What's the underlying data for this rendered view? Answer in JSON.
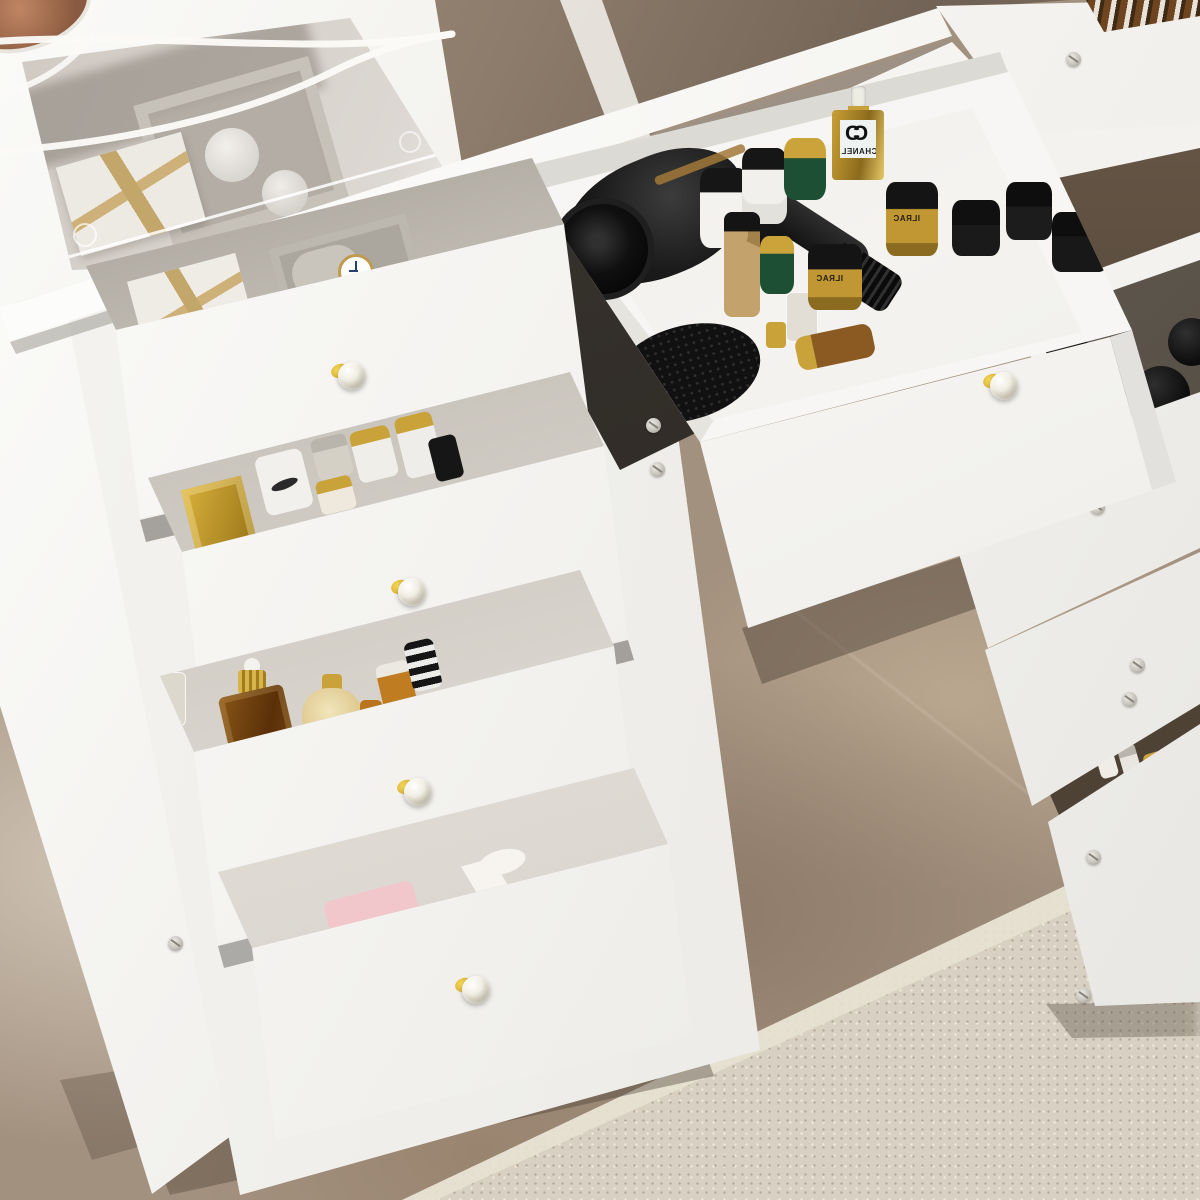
{
  "meta": {
    "description": "Product photo of a white vanity dressing table with a see-through glass top and multiple open crystal-knob drawers filled with cosmetics, perfume bottles, a hair dryer, a brush, a watch and gift boxes, standing on a brown marble floor with a beige rug at lower right."
  },
  "brands": {
    "perfume_logo_left": "C",
    "perfume_logo_right": "C",
    "perfume_name": "CHANEL",
    "jar_label": "ILRAC"
  },
  "palette": {
    "furniture_white": "#f6f5f3",
    "floor_marble": "#a3917f",
    "carpet_beige": "#d8d1c3",
    "glass_tint_brown": "#8d7c6b",
    "gold_accent": "#c9a335",
    "green_jar": "#1d4f35",
    "pink_gift_box": "#efb3b8",
    "appliance_black": "#161616",
    "knob_gold": "#cf9d22"
  },
  "objects": [
    {
      "name": "glass-tabletop",
      "color": "#e3dfda"
    },
    {
      "name": "under-glass-gift-box",
      "color": "#edeae4"
    },
    {
      "name": "under-glass-organizer",
      "color": "#b3ada5"
    },
    {
      "name": "power-cable",
      "color": "#fbfaf7"
    },
    {
      "name": "hair-dryer",
      "color": "#1a1a1a"
    },
    {
      "name": "round-hair-brush",
      "color": "#111111"
    },
    {
      "name": "white-cream-jar-black-lid",
      "color": "#f4f2ee"
    },
    {
      "name": "green-cream-jar-gold-lid",
      "color": "#1d4f35"
    },
    {
      "name": "gold-perfume-bottle-chanel",
      "color": "#caa035"
    },
    {
      "name": "black-cream-jar-gold-label",
      "color": "#c09732"
    },
    {
      "name": "watch-with-gold-rim",
      "color": "#ffffff"
    },
    {
      "name": "white-gift-box-gold-ribbon",
      "color": "#efece6"
    },
    {
      "name": "gold-square-perfume",
      "color": "#c9a335"
    },
    {
      "name": "amber-square-perfume",
      "color": "#6e3f10"
    },
    {
      "name": "cream-round-perfume",
      "color": "#ead9a8"
    },
    {
      "name": "orange-serum-bottles",
      "color": "#c07c20"
    },
    {
      "name": "pink-gift-box-white-ribbon",
      "color": "#efb3b8"
    },
    {
      "name": "black-scalloped-jars",
      "color": "#0a0a0a"
    },
    {
      "name": "crystal-drawer-knobs",
      "color": "#f0ede2"
    },
    {
      "name": "marble-floor",
      "color": "#a3917f"
    },
    {
      "name": "beige-rug",
      "color": "#d8d1c3"
    }
  ]
}
